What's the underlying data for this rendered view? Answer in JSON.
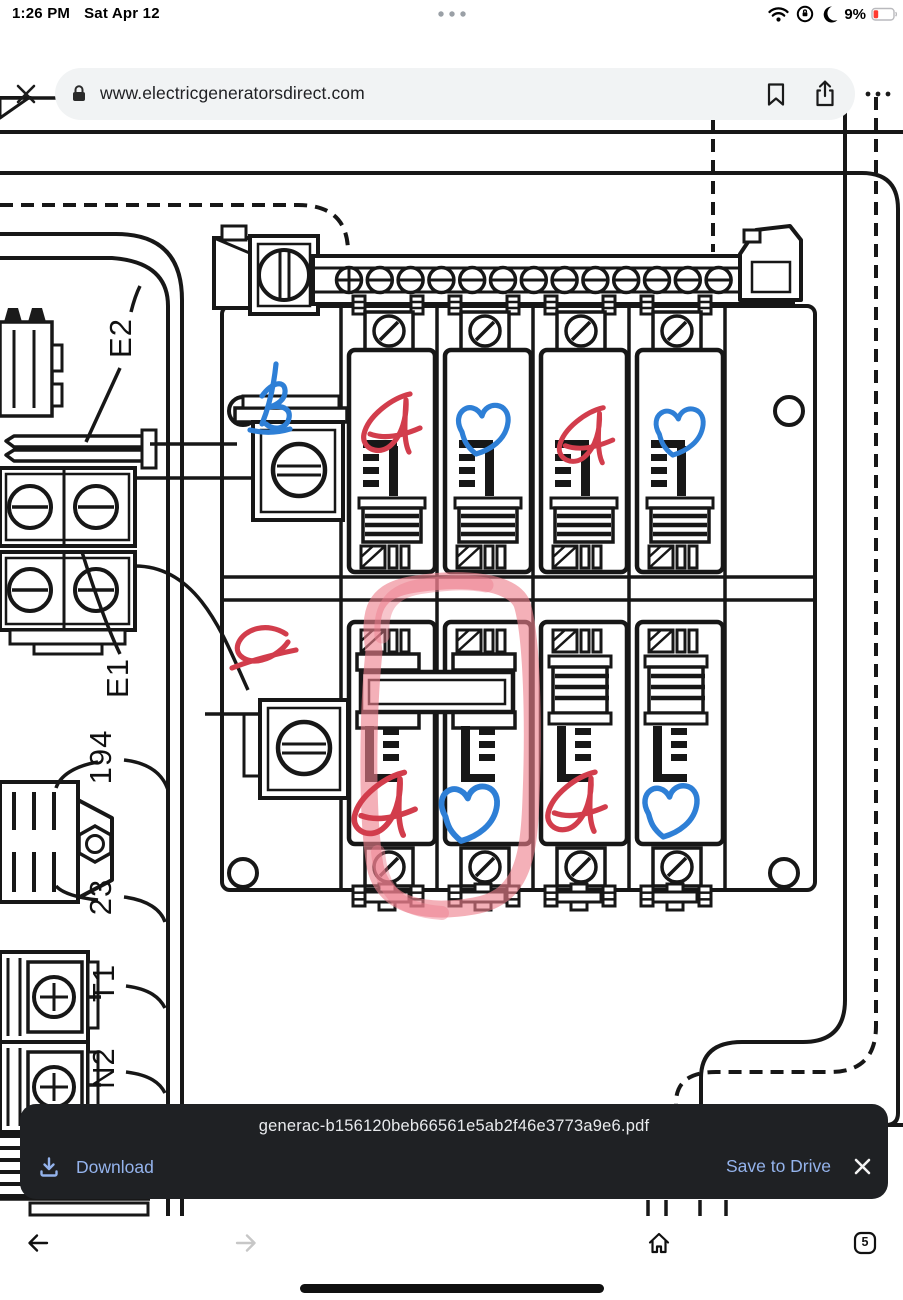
{
  "status_bar": {
    "time": "1:26 PM",
    "date": "Sat Apr 12",
    "battery_percent": "9%",
    "icons": [
      "wifi-icon",
      "rotation-lock-icon",
      "moon-icon",
      "battery-icon"
    ]
  },
  "browser_bar": {
    "url": "www.electricgeneratorsdirect.com",
    "actions": [
      "close",
      "bookmark",
      "share",
      "more"
    ]
  },
  "download_bar": {
    "filename": "generac-b156120beb66561e5ab2f46e3773a9e6.pdf",
    "download_label": "Download",
    "save_label": "Save to Drive",
    "background": "#1f2124",
    "accent": "#94b3ec"
  },
  "bottom_nav": {
    "tab_count": "5"
  },
  "diagram": {
    "line_color": "#171717",
    "ink_red": "#d23d4c",
    "ink_blue": "#2e7fd6",
    "marker_pink": "#ee7f8d",
    "labels": [
      {
        "text": "E2",
        "x": 131,
        "y": 338
      },
      {
        "text": "E1",
        "x": 128,
        "y": 678
      },
      {
        "text": "194",
        "x": 111,
        "y": 757
      },
      {
        "text": "23",
        "x": 111,
        "y": 897
      },
      {
        "text": "T1",
        "x": 114,
        "y": 983
      },
      {
        "text": "N2",
        "x": 114,
        "y": 1068
      }
    ],
    "annotations": [
      {
        "letter": "B",
        "variant": "loop",
        "color": "blue",
        "x": 248,
        "y": 358,
        "s": 1.0
      },
      {
        "letter": "A",
        "variant": "a",
        "color": "red",
        "x": 356,
        "y": 388,
        "s": 1.0
      },
      {
        "letter": "B",
        "variant": "heart",
        "color": "blue",
        "x": 450,
        "y": 396,
        "s": 1.0
      },
      {
        "letter": "A",
        "variant": "a",
        "color": "red",
        "x": 552,
        "y": 402,
        "s": 0.95
      },
      {
        "letter": "B",
        "variant": "heart",
        "color": "blue",
        "x": 648,
        "y": 400,
        "s": 0.95
      },
      {
        "letter": "A",
        "variant": "a2",
        "color": "red",
        "x": 228,
        "y": 620,
        "s": 1.0
      },
      {
        "letter": "A",
        "variant": "a",
        "color": "red",
        "x": 346,
        "y": 766,
        "s": 1.08
      },
      {
        "letter": "B",
        "variant": "heart",
        "color": "blue",
        "x": 432,
        "y": 776,
        "s": 1.12
      },
      {
        "letter": "A",
        "variant": "a",
        "color": "red",
        "x": 540,
        "y": 766,
        "s": 1.02
      },
      {
        "letter": "B",
        "variant": "heart",
        "color": "blue",
        "x": 636,
        "y": 776,
        "s": 1.05
      }
    ]
  }
}
